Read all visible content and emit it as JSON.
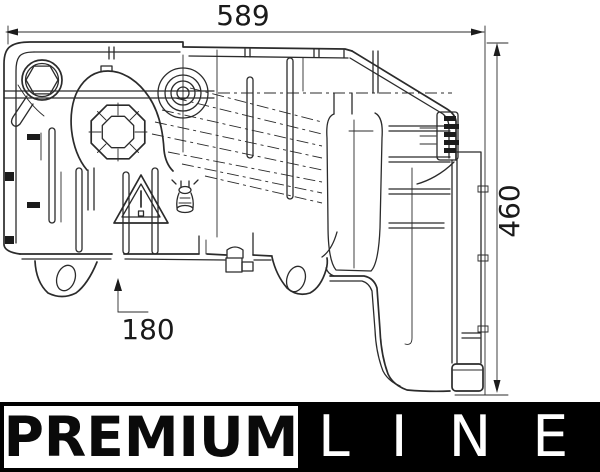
{
  "drawing": {
    "dimensions": {
      "width": "589",
      "height": "460",
      "mount_offset": "180"
    }
  },
  "branding": {
    "premium": "PREMIUM",
    "line": "LINE"
  },
  "colors": {
    "line_stroke": "#2b2b2b",
    "banner_bg": "#000000",
    "line_text_color": "#ffffff",
    "premium_text_color": "#0a0a0a",
    "background": "#ffffff"
  }
}
